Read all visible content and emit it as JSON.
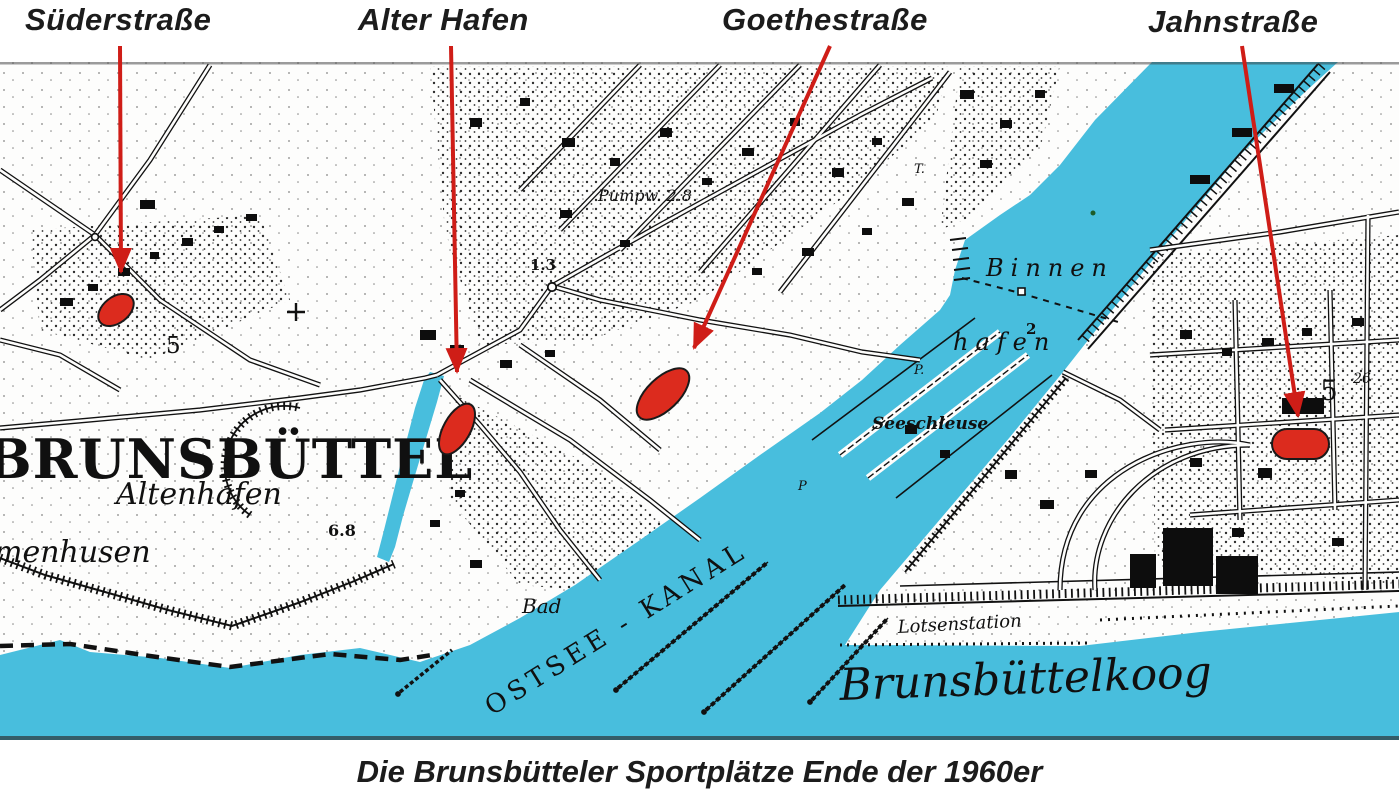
{
  "header": {
    "labels": [
      {
        "text": "Süderstraße"
      },
      {
        "text": "Alter Hafen"
      },
      {
        "text": "Goethestraße"
      },
      {
        "text": "Jahnstraße"
      }
    ]
  },
  "caption": "Die Brunsbütteler Sportplätze Ende der 1960er",
  "map": {
    "labels": {
      "brunsbuettel": "BRUNSBÜTTEL",
      "altenhafen": "Altenhafen",
      "menhusen": "menhusen",
      "height_68": "6.8",
      "binnen": "Binnen",
      "hafen": "hafen",
      "depth_2": "2",
      "seeschleuse": "Seeschleuse",
      "bad": "Bad",
      "ostsee_kanal": "OSTSEE - KANAL",
      "lotsenstation": "Lotsenstation",
      "brunsbuettelkoog": "Brunsbüttelkoog",
      "pumpw": "Pumpw. 2.8",
      "height_13": "1.3",
      "five_left": "5",
      "five_right": "5",
      "twentysix": "26",
      "t_mark": "T.",
      "p_mark1": "P.",
      "p_mark2": "P"
    }
  },
  "colors": {
    "water": "#48bedd",
    "marker_red": "#dc2b1e",
    "arrow_red": "#cf1d17",
    "ink": "#111111",
    "water_text": "#143540"
  }
}
